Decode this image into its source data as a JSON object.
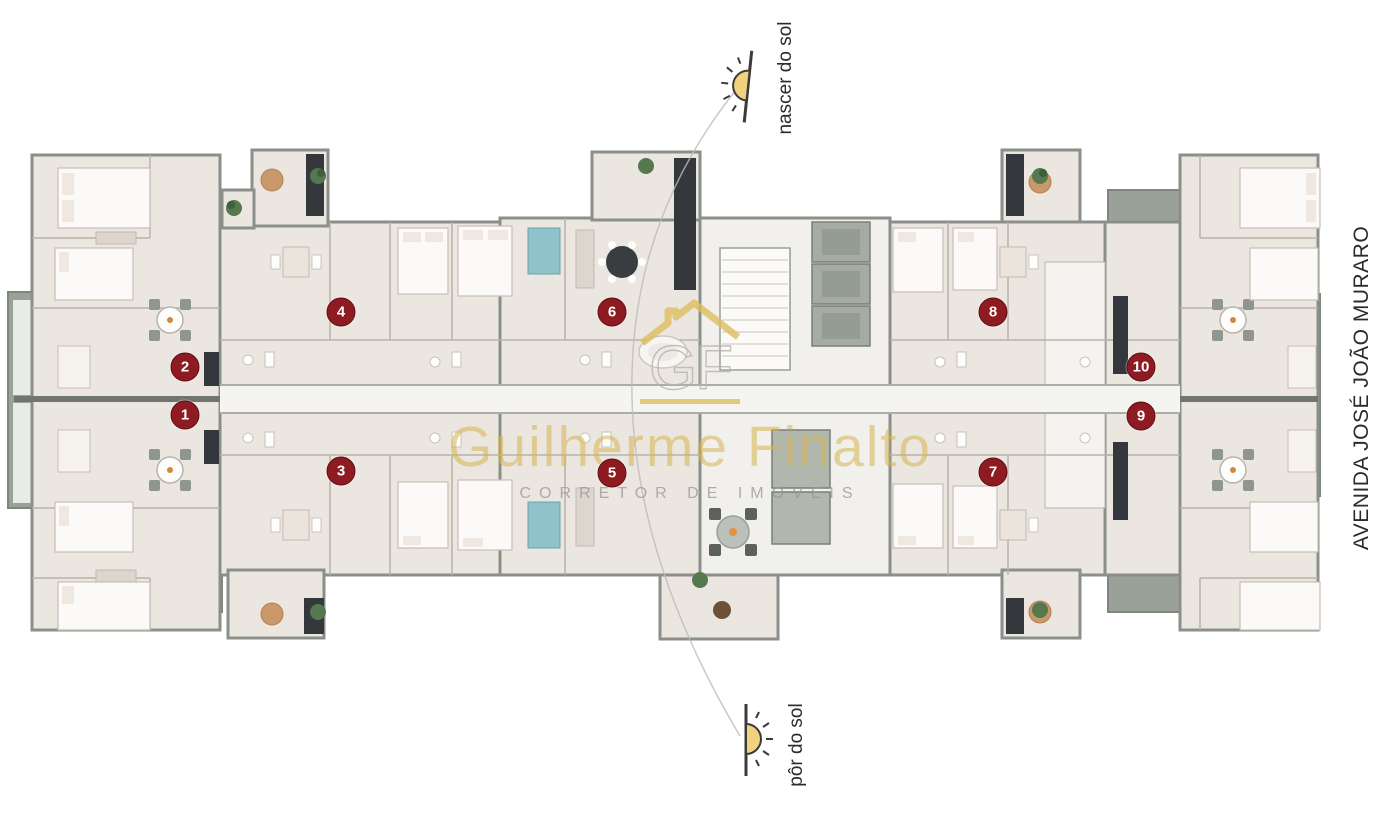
{
  "canvas": {
    "width": 1400,
    "height": 816,
    "background": "#ffffff"
  },
  "annotations": {
    "sunrise": {
      "label": "nascer do sol",
      "icon": "sunrise-icon"
    },
    "sunset": {
      "label": "pôr do sol",
      "icon": "sunset-icon"
    },
    "street": {
      "label": "AVENIDA JOSÉ JOÃO MURARO"
    }
  },
  "watermark": {
    "monogram": "GF",
    "name": "Guilherme Finalto",
    "tagline": "CORRETOR DE IMOVEIS"
  },
  "units": [
    {
      "number": "1",
      "x": 185,
      "y": 415
    },
    {
      "number": "2",
      "x": 185,
      "y": 367
    },
    {
      "number": "3",
      "x": 341,
      "y": 471
    },
    {
      "number": "4",
      "x": 341,
      "y": 312
    },
    {
      "number": "5",
      "x": 612,
      "y": 473
    },
    {
      "number": "6",
      "x": 612,
      "y": 312
    },
    {
      "number": "7",
      "x": 993,
      "y": 472
    },
    {
      "number": "8",
      "x": 993,
      "y": 312
    },
    {
      "number": "9",
      "x": 1141,
      "y": 416
    },
    {
      "number": "10",
      "x": 1141,
      "y": 367
    }
  ],
  "colors": {
    "badge_bg": "#8e1b22",
    "badge_text": "#ffffff",
    "wall": "#8a9089",
    "room": "#ece6e1",
    "terrace": "#9aa198",
    "corridor": "#f6f4f1",
    "sun": "#f2d27c",
    "gold": "#dcbf5e"
  }
}
